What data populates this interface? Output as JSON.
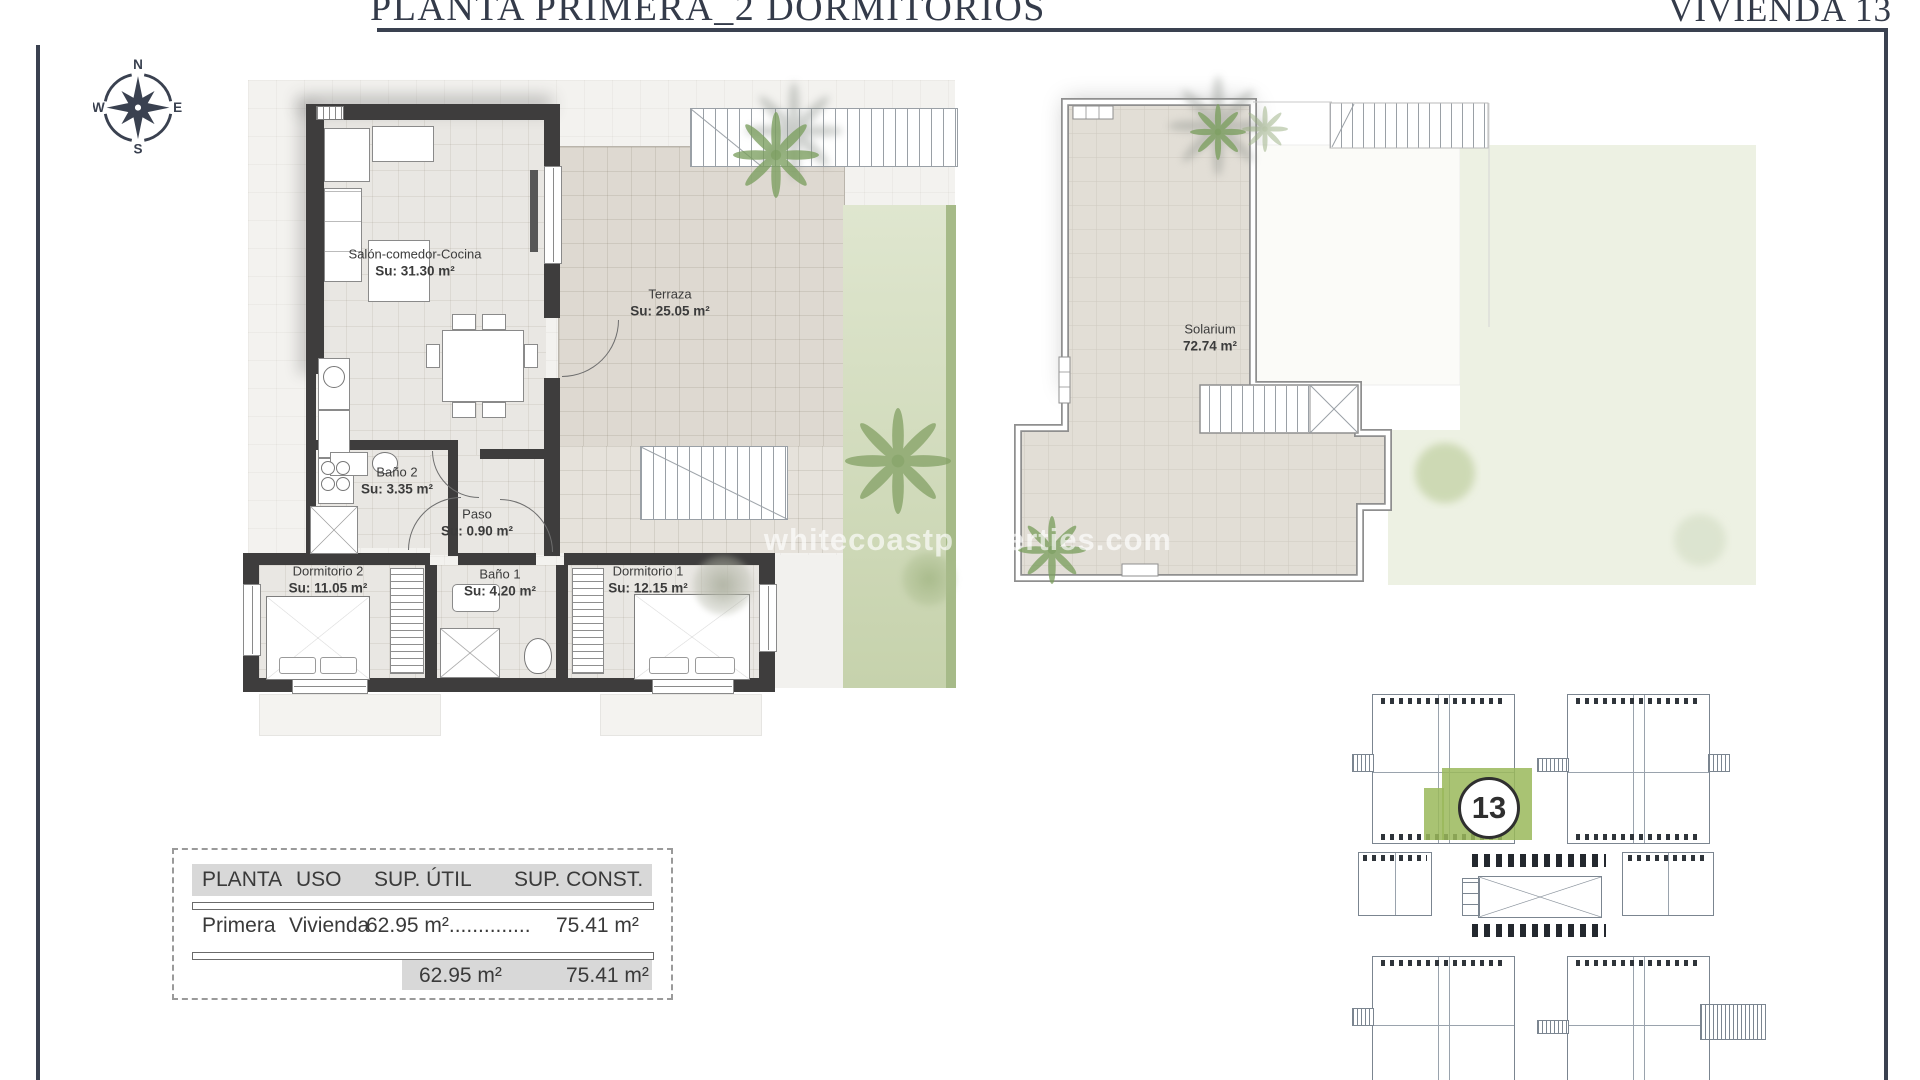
{
  "header": {
    "title": "PLANTA PRIMERA_2 DORMITORIOS",
    "unit_label": "VIVIENDA 13"
  },
  "compass": {
    "north": "N",
    "east": "E",
    "south": "S",
    "west": "W"
  },
  "watermark": "whitecoastproperties.com",
  "floor_plan": {
    "salon": {
      "name": "Salón-comedor-Cocina",
      "area": "Su: 31.30 m²"
    },
    "terraza": {
      "name": "Terraza",
      "area": "Su: 25.05 m²"
    },
    "bano2": {
      "name": "Baño 2",
      "area": "Su: 3.35 m²"
    },
    "paso": {
      "name": "Paso",
      "area": "Su: 0.90 m²"
    },
    "dormitorio2": {
      "name": "Dormitorio 2",
      "area": "Su: 11.05 m²"
    },
    "bano1": {
      "name": "Baño 1",
      "area": "Su: 4.20 m²"
    },
    "dormitorio1": {
      "name": "Dormitorio 1",
      "area": "Su: 12.15 m²"
    },
    "solarium": {
      "name": "Solarium",
      "area": "72.74 m²"
    }
  },
  "surface_table": {
    "headers": [
      "PLANTA",
      "USO",
      "SUP. ÚTIL",
      "SUP. CONST."
    ],
    "row": {
      "planta": "Primera",
      "uso": "Vivienda",
      "sup_util": "62.95 m²..............",
      "sup_const": "75.41 m²"
    },
    "totals": {
      "sup_util": "62.95 m²",
      "sup_const": "75.41 m²"
    }
  },
  "key_plan": {
    "highlighted_unit": "13"
  },
  "colors": {
    "frame": "#3a4150",
    "wall": "#3e3d3d",
    "garden": "#cbd7b3",
    "garden_edge": "#a6ba88",
    "highlight_green": "#9ab85a",
    "tile": "#ded9d1"
  }
}
